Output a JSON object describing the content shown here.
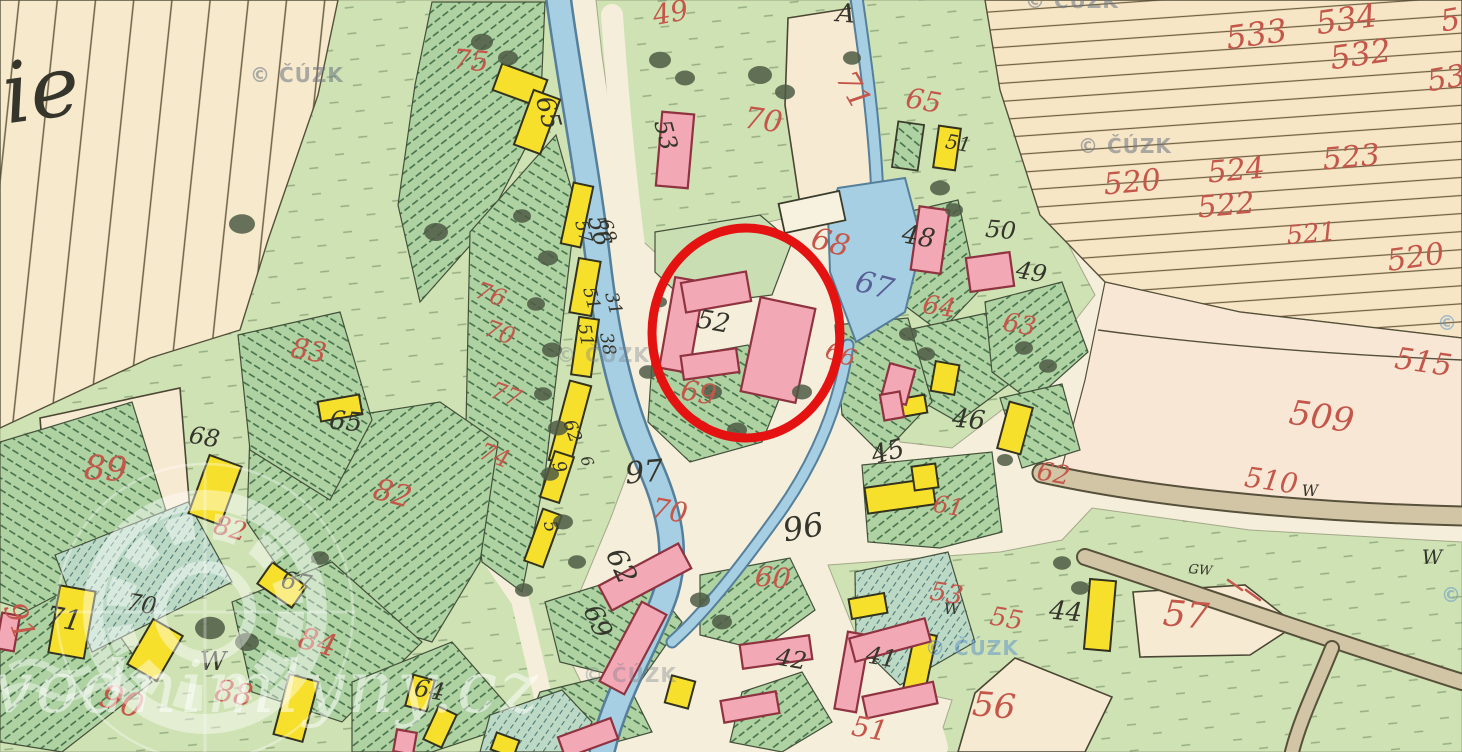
{
  "map": {
    "width": 1462,
    "height": 752,
    "colors": {
      "paper": "#f4eedb",
      "field_cream": "#f6e9cc",
      "field_pink": "#f8e7d4",
      "meadow_green": "#cfe2b4",
      "garden_green": "#aed2a2",
      "teal_green": "#bcd9c5",
      "stream_blue": "#a6cfe3",
      "building_yellow": "#f6e02c",
      "building_pink": "#f3a8b5",
      "road_tan": "#d2c5a6",
      "red_ink": "#c4564a",
      "black_ink": "#35352c",
      "blue_ink": "#5a6097",
      "annotation_red": "#e51212"
    },
    "annotation": {
      "shape": "ellipse",
      "cx": 746,
      "cy": 333,
      "rx": 94,
      "ry": 105,
      "color": "#e51212",
      "stroke_width": 9
    },
    "handwriting_note": {
      "t": "ie",
      "x": 45,
      "y": 118,
      "s": 84,
      "c": "b",
      "r": -8
    },
    "labels": [
      [
        "49",
        672,
        22,
        28,
        "r",
        -10
      ],
      [
        "75",
        470,
        70,
        28,
        "r",
        5
      ],
      [
        "70",
        762,
        130,
        30,
        "r",
        8
      ],
      [
        "71",
        845,
        95,
        30,
        "r",
        60
      ],
      [
        "65",
        922,
        110,
        28,
        "r",
        10
      ],
      [
        "68",
        828,
        252,
        30,
        "r",
        15
      ],
      [
        "67",
        872,
        295,
        30,
        "u",
        15
      ],
      [
        "66",
        838,
        362,
        24,
        "r",
        20
      ],
      [
        "69",
        697,
        402,
        28,
        "r",
        10
      ],
      [
        "64",
        938,
        315,
        26,
        "r",
        8
      ],
      [
        "63",
        1018,
        333,
        26,
        "r",
        10
      ],
      [
        "62",
        1052,
        482,
        26,
        "r",
        10
      ],
      [
        "61",
        947,
        514,
        24,
        "r",
        10
      ],
      [
        "83",
        307,
        360,
        28,
        "r",
        10
      ],
      [
        "82",
        390,
        503,
        30,
        "r",
        15
      ],
      [
        "82",
        228,
        537,
        26,
        "r",
        15
      ],
      [
        "89",
        105,
        480,
        34,
        "r",
        3
      ],
      [
        "90",
        118,
        712,
        34,
        "r",
        20
      ],
      [
        "91",
        10,
        625,
        30,
        "r",
        70
      ],
      [
        "88",
        232,
        703,
        30,
        "r",
        10
      ],
      [
        "84",
        315,
        652,
        30,
        "r",
        15
      ],
      [
        "76",
        488,
        302,
        24,
        "r",
        20
      ],
      [
        "70",
        497,
        340,
        24,
        "r",
        20
      ],
      [
        "77",
        503,
        402,
        24,
        "r",
        20
      ],
      [
        "74",
        492,
        463,
        24,
        "r",
        20
      ],
      [
        "70",
        668,
        520,
        28,
        "r",
        10
      ],
      [
        "60",
        772,
        587,
        28,
        "r",
        5
      ],
      [
        "51",
        868,
        738,
        28,
        "r",
        10
      ],
      [
        "53",
        945,
        602,
        26,
        "r",
        10
      ],
      [
        "55",
        1005,
        627,
        26,
        "r",
        10
      ],
      [
        "57",
        1185,
        627,
        36,
        "r",
        5
      ],
      [
        "56",
        993,
        717,
        34,
        "r",
        5
      ],
      [
        "515",
        1422,
        372,
        30,
        "r",
        8
      ],
      [
        "509",
        1320,
        428,
        34,
        "r",
        8
      ],
      [
        "510",
        1270,
        490,
        28,
        "r",
        8
      ],
      [
        "533",
        1258,
        45,
        32,
        "r",
        -8
      ],
      [
        "534",
        1348,
        30,
        32,
        "r",
        -8
      ],
      [
        "532",
        1362,
        65,
        32,
        "r",
        -8
      ],
      [
        "53",
        1448,
        88,
        30,
        "r",
        -10
      ],
      [
        "5",
        1452,
        30,
        30,
        "r",
        -10
      ],
      [
        "520",
        1133,
        192,
        30,
        "r",
        -5
      ],
      [
        "524",
        1237,
        180,
        30,
        "r",
        -5
      ],
      [
        "523",
        1352,
        167,
        30,
        "r",
        -5
      ],
      [
        "522",
        1227,
        215,
        30,
        "r",
        -5
      ],
      [
        "521",
        1312,
        242,
        26,
        "r",
        -5
      ],
      [
        "520",
        1417,
        267,
        30,
        "r",
        -8
      ],
      [
        "A",
        845,
        22,
        26,
        "b",
        5
      ],
      [
        "65",
        540,
        115,
        26,
        "b",
        75
      ],
      [
        "56",
        592,
        233,
        24,
        "b",
        75
      ],
      [
        "53",
        658,
        137,
        24,
        "b",
        75
      ],
      [
        "51",
        957,
        150,
        20,
        "b",
        10
      ],
      [
        "50",
        1000,
        238,
        24,
        "b",
        5
      ],
      [
        "49",
        1030,
        280,
        24,
        "b",
        10
      ],
      [
        "48",
        917,
        245,
        26,
        "b",
        10
      ],
      [
        "52",
        712,
        330,
        26,
        "b",
        10
      ],
      [
        "97",
        645,
        482,
        30,
        "b",
        -5
      ],
      [
        "96",
        805,
        538,
        32,
        "b",
        -10
      ],
      [
        "62",
        613,
        570,
        28,
        "b",
        65
      ],
      [
        "69",
        590,
        625,
        26,
        "b",
        65
      ],
      [
        "42",
        790,
        667,
        24,
        "b",
        10
      ],
      [
        "41",
        880,
        665,
        24,
        "b",
        10
      ],
      [
        "45",
        890,
        460,
        26,
        "b",
        -15
      ],
      [
        "46",
        968,
        428,
        26,
        "b",
        5
      ],
      [
        "71",
        62,
        628,
        28,
        "b",
        10
      ],
      [
        "70",
        140,
        612,
        24,
        "b",
        10
      ],
      [
        "68",
        203,
        445,
        24,
        "b",
        10
      ],
      [
        "65",
        345,
        430,
        26,
        "b",
        5
      ],
      [
        "67",
        295,
        590,
        24,
        "b",
        10
      ],
      [
        "64",
        428,
        698,
        24,
        "b",
        10
      ],
      [
        "44",
        1065,
        620,
        26,
        "b",
        5
      ],
      [
        "W",
        213,
        670,
        26,
        "b",
        0
      ],
      [
        "W",
        952,
        614,
        16,
        "b",
        0
      ],
      [
        "W",
        1432,
        564,
        20,
        "b",
        0
      ],
      [
        "W",
        1310,
        496,
        16,
        "b",
        0
      ],
      [
        "GW",
        1200,
        574,
        13,
        "b",
        5
      ],
      [
        "57",
        578,
        233,
        18,
        "b",
        75
      ],
      [
        "68",
        602,
        232,
        18,
        "b",
        75
      ],
      [
        "51",
        586,
        300,
        18,
        "b",
        75
      ],
      [
        "31",
        608,
        305,
        18,
        "b",
        75
      ],
      [
        "51",
        580,
        336,
        18,
        "b",
        80
      ],
      [
        "38",
        602,
        345,
        18,
        "b",
        80
      ],
      [
        "62",
        567,
        433,
        18,
        "b",
        70
      ],
      [
        "9",
        554,
        469,
        18,
        "b",
        70
      ],
      [
        "5",
        545,
        528,
        18,
        "b",
        75
      ],
      [
        "6",
        582,
        463,
        16,
        "b",
        70
      ]
    ],
    "watermarks": {
      "cuzk": {
        "text": "© ČÚZK",
        "positions": [
          [
            250,
            82,
            "gray"
          ],
          [
            1025,
            8,
            "gray"
          ],
          [
            1078,
            153,
            "gray"
          ],
          [
            556,
            362,
            "faint"
          ],
          [
            583,
            682,
            "faint"
          ],
          [
            925,
            655,
            "blue"
          ],
          [
            1437,
            330,
            "blue"
          ],
          [
            1441,
            602,
            "blue"
          ]
        ]
      },
      "mill": {
        "text": "vodnimlyny.cz",
        "x": -8,
        "y": 712,
        "size": 72,
        "logo": {
          "cx": 205,
          "cy": 612,
          "r": 112
        }
      }
    },
    "buildings": {
      "yellow": [
        [
          520,
          85,
          48,
          28,
          20
        ],
        [
          537,
          122,
          28,
          58,
          20
        ],
        [
          947,
          148,
          22,
          42,
          8
        ],
        [
          577,
          215,
          20,
          62,
          12
        ],
        [
          585,
          287,
          22,
          55,
          10
        ],
        [
          585,
          347,
          20,
          58,
          8
        ],
        [
          570,
          423,
          22,
          82,
          15
        ],
        [
          557,
          477,
          20,
          48,
          18
        ],
        [
          543,
          538,
          20,
          55,
          20
        ],
        [
          340,
          408,
          42,
          20,
          -10
        ],
        [
          215,
          490,
          34,
          62,
          20
        ],
        [
          282,
          585,
          42,
          26,
          35
        ],
        [
          72,
          622,
          36,
          68,
          10
        ],
        [
          155,
          650,
          34,
          52,
          30
        ],
        [
          296,
          708,
          30,
          62,
          15
        ],
        [
          420,
          693,
          22,
          32,
          15
        ],
        [
          440,
          727,
          20,
          36,
          25
        ],
        [
          680,
          692,
          24,
          28,
          15
        ],
        [
          945,
          378,
          24,
          30,
          10
        ],
        [
          1015,
          428,
          24,
          48,
          15
        ],
        [
          912,
          406,
          28,
          18,
          -10
        ],
        [
          900,
          496,
          68,
          26,
          -8
        ],
        [
          925,
          477,
          24,
          24,
          -8
        ],
        [
          868,
          606,
          36,
          20,
          -10
        ],
        [
          920,
          662,
          22,
          58,
          12
        ],
        [
          1100,
          615,
          26,
          70,
          5
        ],
        [
          505,
          745,
          24,
          18,
          20
        ]
      ],
      "pink": [
        [
          675,
          150,
          32,
          74,
          5
        ],
        [
          930,
          240,
          30,
          64,
          8
        ],
        [
          990,
          272,
          44,
          34,
          -8
        ],
        [
          898,
          384,
          26,
          36,
          15
        ],
        [
          682,
          325,
          30,
          92,
          10
        ],
        [
          716,
          292,
          66,
          30,
          -10
        ],
        [
          778,
          350,
          56,
          96,
          12
        ],
        [
          710,
          364,
          56,
          24,
          -8
        ],
        [
          645,
          577,
          90,
          28,
          -28
        ],
        [
          633,
          648,
          28,
          90,
          28
        ],
        [
          776,
          652,
          70,
          24,
          -8
        ],
        [
          750,
          707,
          56,
          22,
          -10
        ],
        [
          852,
          672,
          22,
          78,
          10
        ],
        [
          890,
          640,
          78,
          24,
          -15
        ],
        [
          900,
          700,
          72,
          22,
          -12
        ],
        [
          588,
          738,
          56,
          22,
          -20
        ],
        [
          8,
          632,
          18,
          36,
          10
        ],
        [
          405,
          742,
          20,
          22,
          10
        ],
        [
          892,
          406,
          20,
          26,
          -10
        ]
      ],
      "white": [
        [
          812,
          212,
          62,
          30,
          -12
        ]
      ],
      "hatched": [
        [
          908,
          146,
          26,
          46,
          8
        ]
      ]
    },
    "trees": [
      [
        482,
        42,
        11
      ],
      [
        508,
        58,
        10
      ],
      [
        660,
        60,
        11
      ],
      [
        685,
        78,
        10
      ],
      [
        760,
        75,
        12
      ],
      [
        785,
        92,
        10
      ],
      [
        852,
        58,
        9
      ],
      [
        940,
        188,
        10
      ],
      [
        954,
        210,
        9
      ],
      [
        242,
        224,
        13
      ],
      [
        436,
        232,
        12
      ],
      [
        522,
        216,
        9
      ],
      [
        548,
        258,
        10
      ],
      [
        536,
        304,
        9
      ],
      [
        552,
        350,
        10
      ],
      [
        543,
        394,
        9
      ],
      [
        558,
        428,
        10
      ],
      [
        550,
        474,
        9
      ],
      [
        563,
        522,
        10
      ],
      [
        577,
        562,
        9
      ],
      [
        524,
        590,
        9
      ],
      [
        648,
        372,
        9
      ],
      [
        712,
        392,
        10
      ],
      [
        737,
        430,
        10
      ],
      [
        908,
        334,
        9
      ],
      [
        926,
        354,
        9
      ],
      [
        1024,
        348,
        9
      ],
      [
        1048,
        366,
        9
      ],
      [
        1062,
        563,
        9
      ],
      [
        1080,
        588,
        9
      ],
      [
        210,
        628,
        15
      ],
      [
        247,
        642,
        12
      ],
      [
        700,
        600,
        10
      ],
      [
        722,
        622,
        10
      ],
      [
        320,
        558,
        9
      ],
      [
        660,
        302,
        7
      ],
      [
        802,
        392,
        10
      ],
      [
        1005,
        460,
        8
      ]
    ]
  }
}
